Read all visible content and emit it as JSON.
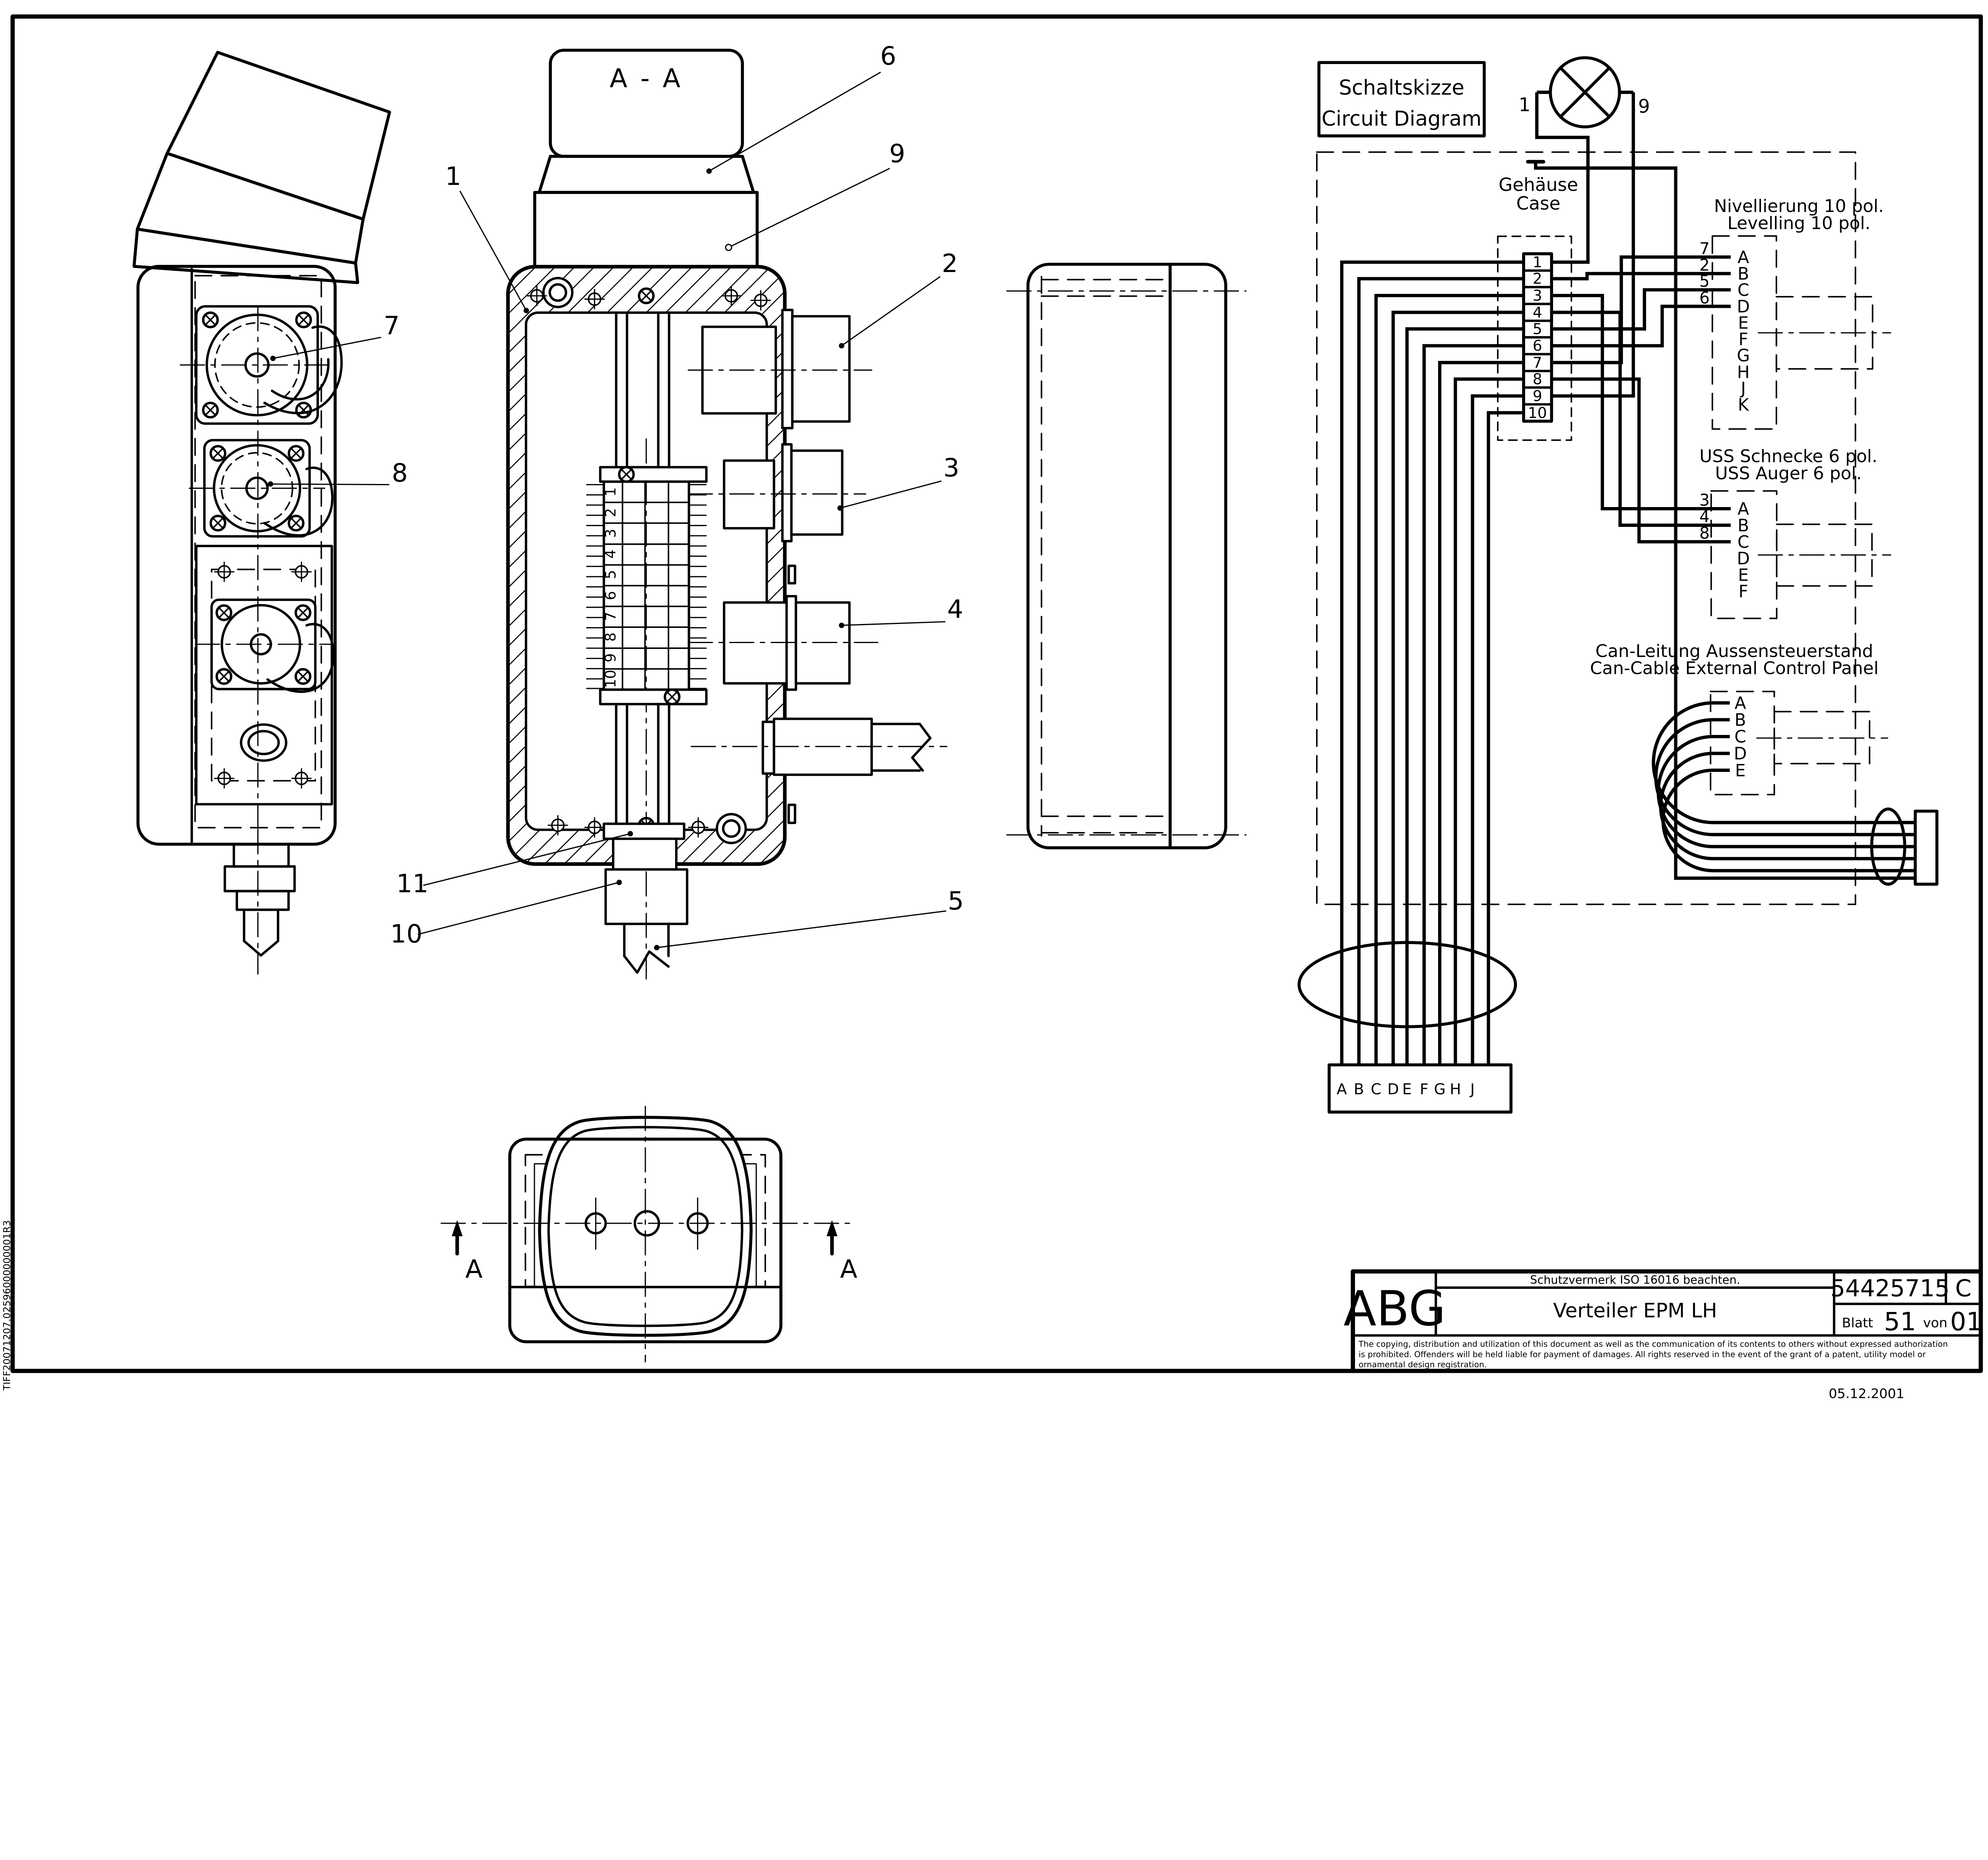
{
  "drawing": {
    "section_label": "A - A",
    "section_arrow_label": "A",
    "vertical_code": "TIFF20071207.02596000000001R3",
    "date": "05.12.2001",
    "callouts": [
      "1",
      "2",
      "3",
      "4",
      "5",
      "6",
      "7",
      "8",
      "9",
      "10",
      "11"
    ]
  },
  "circuit": {
    "title_de": "Schaltskizze",
    "title_en": "Circuit Diagram",
    "lamp_pin_left": "1",
    "lamp_pin_right": "9",
    "case_de": "Gehäuse",
    "case_en": "Case",
    "terminals": [
      "1",
      "2",
      "3",
      "4",
      "5",
      "6",
      "7",
      "8",
      "9",
      "10"
    ],
    "nivellierung": {
      "title_de": "Nivellierung 10 pol.",
      "title_en": "Levelling 10 pol.",
      "pins": [
        "A",
        "B",
        "C",
        "D",
        "E",
        "F",
        "G",
        "H",
        "J",
        "K"
      ],
      "wires": [
        "7",
        "2",
        "5",
        "6"
      ]
    },
    "uss": {
      "title_de": "USS Schnecke 6 pol.",
      "title_en": "USS Auger 6 pol.",
      "pins": [
        "A",
        "B",
        "C",
        "D",
        "E",
        "F"
      ],
      "wires": [
        "3",
        "4",
        "8"
      ]
    },
    "can": {
      "title_de": "Can-Leitung Aussensteuerstand",
      "title_en": "Can-Cable External Control Panel",
      "pins": [
        "A",
        "B",
        "C",
        "D",
        "E"
      ]
    },
    "cable_pins": [
      "A",
      "B",
      "C",
      "D",
      "E",
      "F",
      "G",
      "H",
      "J"
    ]
  },
  "title_block": {
    "logo": "ABG",
    "notice": "Schutzvermerk ISO 16016 beachten.",
    "title": "Verteiler EPM LH",
    "doc_number": "54425715",
    "revision": "C",
    "sheet_label": "Blatt",
    "sheet_number": "51",
    "of_label": "von",
    "of_total": "01",
    "legal": [
      "The copying, distribution and utilization of this document as well as the communication of its contents to others without expressed authorization",
      "is prohibited. Offenders will be held liable for payment of damages. All rights reserved in the event of the grant of a patent, utility model or",
      "ornamental design registration."
    ]
  }
}
